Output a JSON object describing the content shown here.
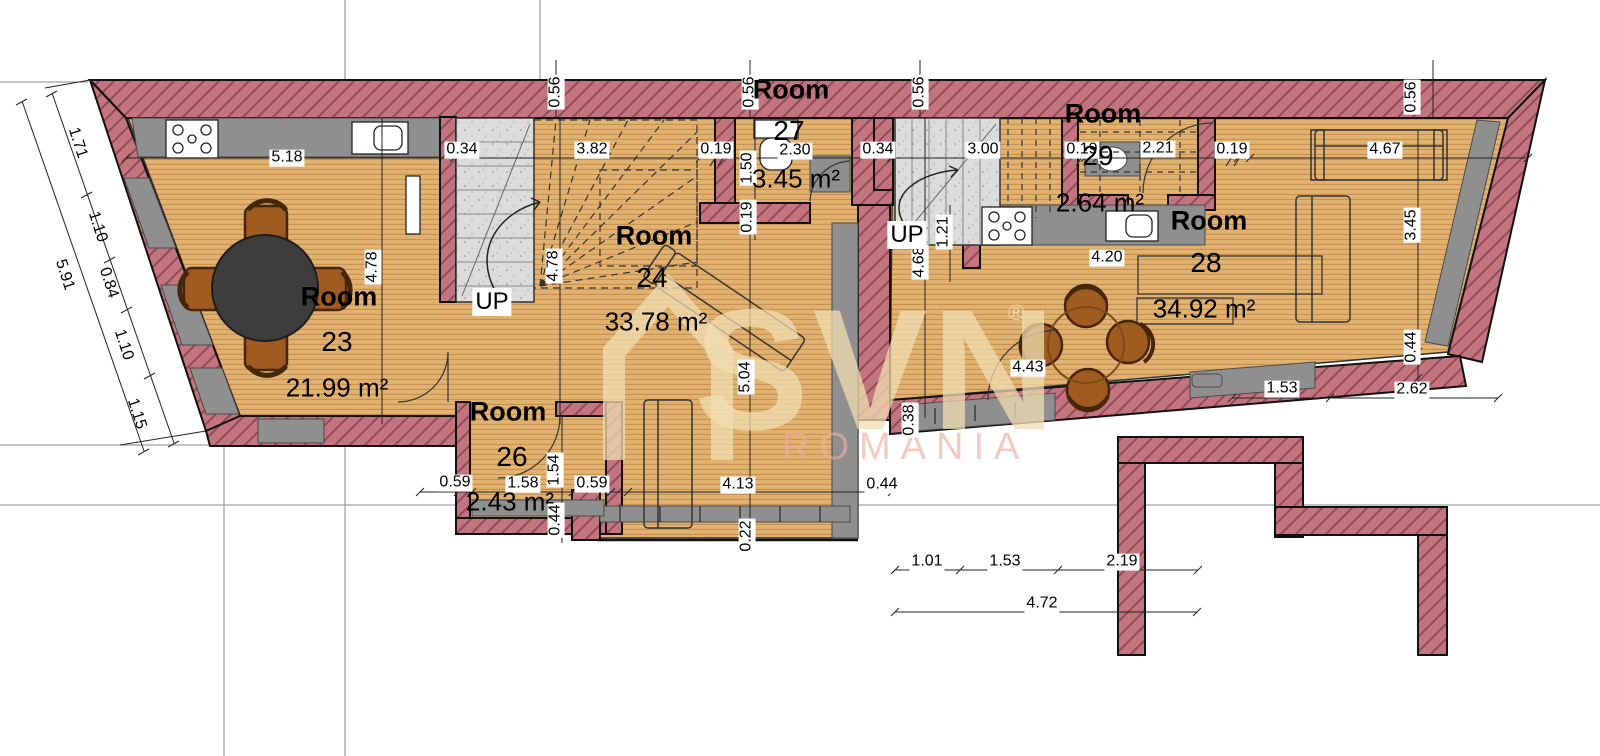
{
  "title": "Floor plan",
  "watermark": {
    "brand": "SVN",
    "registered": "®",
    "sub": "ROMANIA"
  },
  "colors": {
    "wall_pink": "#c4747e",
    "wall_hatch_line": "#8d4b57",
    "wood": "#e2b271",
    "wood_line": "#c49153",
    "gray_fixture": "#8f8f8f",
    "concrete": "#dcdcdc",
    "outline": "#111111",
    "chair_brown": "#a05c20",
    "table_dark": "#3d3d3d",
    "watermark_beige": "#f0deb2",
    "watermark_pink": "#ecaca0"
  },
  "stairs": [
    {
      "label": "UP",
      "x": 492,
      "y": 302
    },
    {
      "label": "UP",
      "x": 907,
      "y": 235
    }
  ],
  "rooms": [
    {
      "name": "Room",
      "number": "23",
      "area": "21.99 m²",
      "label": {
        "x": 339,
        "y": 297
      },
      "num": {
        "x": 337,
        "y": 342
      },
      "areapos": {
        "x": 337,
        "y": 388
      }
    },
    {
      "name": "Room",
      "number": "24",
      "area": "33.78 m²",
      "label": {
        "x": 654,
        "y": 236
      },
      "num": {
        "x": 652,
        "y": 278
      },
      "areapos": {
        "x": 656,
        "y": 322
      }
    },
    {
      "name": "Room",
      "number": "26",
      "area": "2.43 m²",
      "label": {
        "x": 508,
        "y": 412
      },
      "num": {
        "x": 512,
        "y": 457
      },
      "areapos": {
        "x": 510,
        "y": 502
      }
    },
    {
      "name": "Room",
      "number": "27",
      "area": "3.45 m²",
      "label": {
        "x": 791,
        "y": 90
      },
      "num": {
        "x": 789,
        "y": 131
      },
      "areapos": {
        "x": 796,
        "y": 179
      }
    },
    {
      "name": "Room",
      "number": "28",
      "area": "34.92 m²",
      "label": {
        "x": 1209,
        "y": 221
      },
      "num": {
        "x": 1206,
        "y": 263
      },
      "areapos": {
        "x": 1204,
        "y": 309
      }
    },
    {
      "name": "Room",
      "number": "29",
      "area": "2.64 m²",
      "label": {
        "x": 1103,
        "y": 114
      },
      "num": {
        "x": 1098,
        "y": 156
      },
      "areapos": {
        "x": 1100,
        "y": 203
      }
    }
  ],
  "dimensions": [
    {
      "text": "5.18",
      "x": 287,
      "y": 158,
      "o": "h"
    },
    {
      "text": "0.34",
      "x": 462,
      "y": 150,
      "o": "h"
    },
    {
      "text": "3.82",
      "x": 592,
      "y": 150,
      "o": "h"
    },
    {
      "text": "0.19",
      "x": 716,
      "y": 150,
      "o": "h"
    },
    {
      "text": "2.30",
      "x": 795,
      "y": 151,
      "o": "h"
    },
    {
      "text": "0.34",
      "x": 878,
      "y": 150,
      "o": "h"
    },
    {
      "text": "3.00",
      "x": 983,
      "y": 150,
      "o": "h"
    },
    {
      "text": "0.19",
      "x": 1082,
      "y": 150,
      "o": "h"
    },
    {
      "text": "2.21",
      "x": 1158,
      "y": 149,
      "o": "h"
    },
    {
      "text": "0.19",
      "x": 1232,
      "y": 150,
      "o": "h"
    },
    {
      "text": "4.67",
      "x": 1385,
      "y": 150,
      "o": "h"
    },
    {
      "text": "4.20",
      "x": 1107,
      "y": 258,
      "o": "h"
    },
    {
      "text": "4.43",
      "x": 1028,
      "y": 368,
      "o": "h"
    },
    {
      "text": "4.13",
      "x": 738,
      "y": 485,
      "o": "h"
    },
    {
      "text": "0.59",
      "x": 455,
      "y": 483,
      "o": "h"
    },
    {
      "text": "1.58",
      "x": 523,
      "y": 484,
      "o": "h"
    },
    {
      "text": "0.59",
      "x": 592,
      "y": 484,
      "o": "h"
    },
    {
      "text": "0.44",
      "x": 882,
      "y": 485,
      "o": "h"
    },
    {
      "text": "1.01",
      "x": 927,
      "y": 562,
      "o": "h"
    },
    {
      "text": "1.53",
      "x": 1005,
      "y": 562,
      "o": "h"
    },
    {
      "text": "2.19",
      "x": 1122,
      "y": 562,
      "o": "h"
    },
    {
      "text": "4.72",
      "x": 1042,
      "y": 604,
      "o": "h"
    },
    {
      "text": "1.53",
      "x": 1282,
      "y": 389,
      "o": "h"
    },
    {
      "text": "2.62",
      "x": 1412,
      "y": 390,
      "o": "h"
    },
    {
      "text": "0.56",
      "x": 556,
      "y": 92,
      "o": "v"
    },
    {
      "text": "0.56",
      "x": 750,
      "y": 92,
      "o": "v"
    },
    {
      "text": "0.56",
      "x": 920,
      "y": 92,
      "o": "v"
    },
    {
      "text": "0.56",
      "x": 1412,
      "y": 97,
      "o": "v"
    },
    {
      "text": "4.78",
      "x": 373,
      "y": 267,
      "o": "v"
    },
    {
      "text": "4.78",
      "x": 554,
      "y": 266,
      "o": "v"
    },
    {
      "text": "1.50",
      "x": 748,
      "y": 168,
      "o": "v"
    },
    {
      "text": "0.19",
      "x": 748,
      "y": 217,
      "o": "v"
    },
    {
      "text": "1.21",
      "x": 944,
      "y": 232,
      "o": "v"
    },
    {
      "text": "4.68",
      "x": 920,
      "y": 262,
      "o": "v"
    },
    {
      "text": "5.04",
      "x": 746,
      "y": 377,
      "o": "v"
    },
    {
      "text": "0.38",
      "x": 910,
      "y": 420,
      "o": "v"
    },
    {
      "text": "1.54",
      "x": 555,
      "y": 470,
      "o": "v"
    },
    {
      "text": "0.44",
      "x": 556,
      "y": 520,
      "o": "v"
    },
    {
      "text": "0.22",
      "x": 747,
      "y": 536,
      "o": "v"
    },
    {
      "text": "3.45",
      "x": 1412,
      "y": 225,
      "o": "v"
    },
    {
      "text": "0.44",
      "x": 1412,
      "y": 347,
      "o": "v"
    },
    {
      "text": "1.71",
      "x": 77,
      "y": 143,
      "o": "s"
    },
    {
      "text": "1.10",
      "x": 97,
      "y": 227,
      "o": "s"
    },
    {
      "text": "0.84",
      "x": 108,
      "y": 283,
      "o": "s"
    },
    {
      "text": "1.10",
      "x": 123,
      "y": 345,
      "o": "s"
    },
    {
      "text": "1.15",
      "x": 136,
      "y": 414,
      "o": "s"
    },
    {
      "text": "5.91",
      "x": 64,
      "y": 275,
      "o": "s"
    }
  ]
}
